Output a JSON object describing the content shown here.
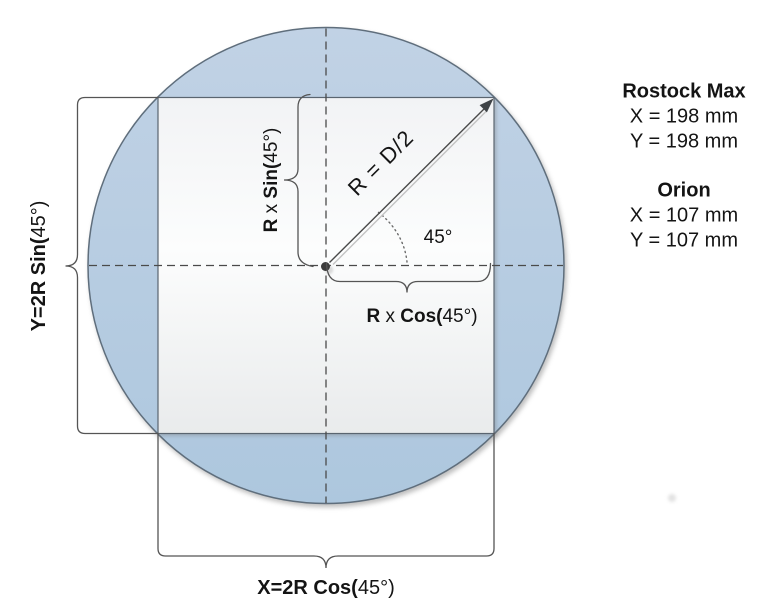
{
  "diagram": {
    "labels": {
      "radius": "R = D/2",
      "angle": "45°",
      "r_sin": {
        "p1": "R",
        "p2": " x ",
        "p3": "Sin(",
        "p4": "45°)"
      },
      "r_cos": {
        "p1": "R",
        "p2": " x ",
        "p3": "Cos(",
        "p4": "45°)"
      },
      "y_dim": {
        "p1": "Y=2R Sin(",
        "p2": "45°)"
      },
      "x_dim": {
        "p1": "X=2R Cos(",
        "p2": "45°)"
      }
    },
    "colors": {
      "bed_fill_top": "#c1d2e5",
      "bed_fill_bottom": "#adc7de",
      "square_fill_top": "#f2f3f5",
      "square_fill_mid": "#fcfdfd",
      "square_fill_bottom": "#e9ebec"
    }
  },
  "legend": {
    "printers": [
      {
        "name": "Rostock Max",
        "x": "X = 198 mm",
        "y": "Y = 198 mm"
      },
      {
        "name": "Orion",
        "x": "X = 107 mm",
        "y": "Y = 107 mm"
      }
    ]
  }
}
